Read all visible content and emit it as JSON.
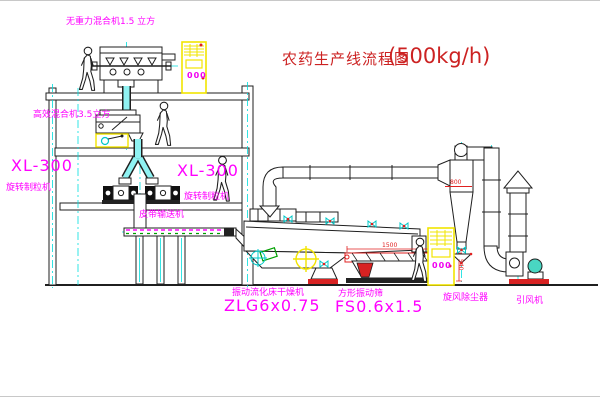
{
  "title": {
    "text": "农药生产线流程图",
    "capacity": "(500kg/h)"
  },
  "equipment": {
    "gravity_mixer": {
      "label": "无重力混合机1.5 立方"
    },
    "high_eff_mixer": {
      "label": "高效混合机3.5立方"
    },
    "granulator_left": {
      "model": "XL-300",
      "name": "旋转制粒机"
    },
    "granulator_right": {
      "model": "XL-300",
      "name": "旋转制粒机"
    },
    "belt_conveyor": {
      "name": "皮带输送机"
    },
    "dryer": {
      "name": "振动流化床干燥机",
      "model": "ZLG6x0.75"
    },
    "screen": {
      "name": "方形振动筛",
      "model": "FS0.6x1.5"
    },
    "cyclone": {
      "name": "旋风除尘器"
    },
    "fan": {
      "name": "引风机"
    }
  },
  "dimensions": {
    "screen_length": "1500",
    "screen_outlet_height": "540",
    "cyclone_band": "800"
  },
  "cabinets": {
    "display": "000"
  },
  "icons": {
    "person": "person-icon",
    "valve": "valve-icon"
  },
  "colors": {
    "background": "#ffffff",
    "linework": "#1f1f1f",
    "centerline": "#00dede",
    "label_magenta": "#ff00ff",
    "title_red": "#cc2222",
    "dimension_red": "#e02020",
    "cabinet_yellow": "#f2e400",
    "accent_green": "#00a000"
  }
}
